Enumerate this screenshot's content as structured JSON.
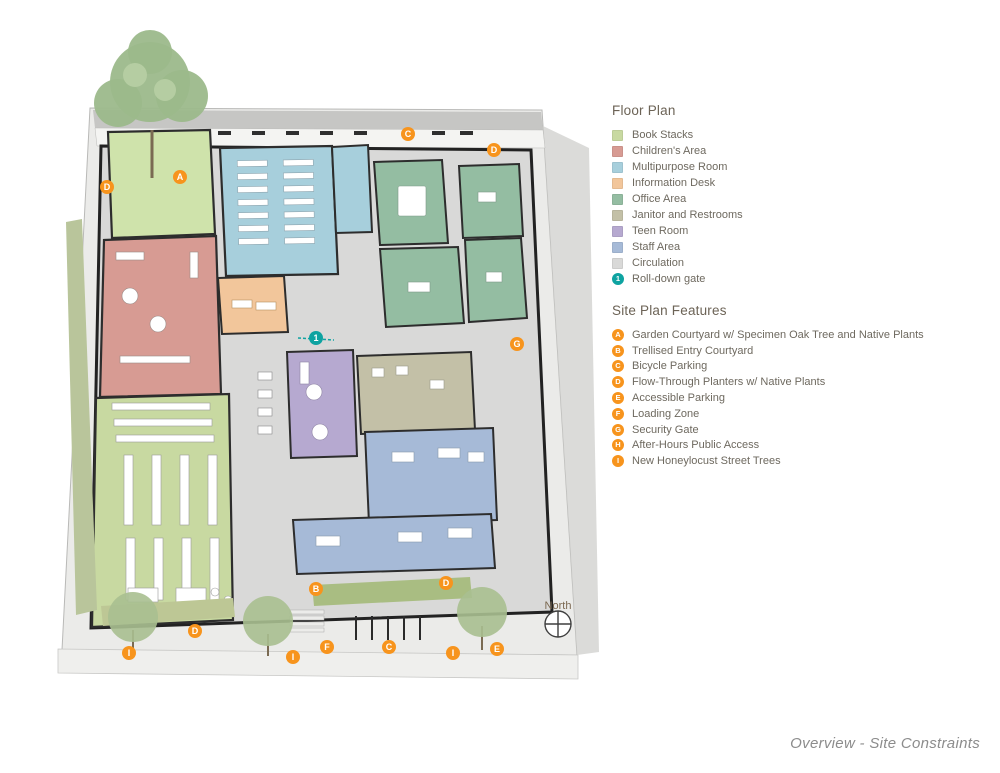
{
  "legend": {
    "floor_plan": {
      "title": "Floor Plan",
      "items": [
        {
          "label": "Book Stacks",
          "color": "#c8d9a1"
        },
        {
          "label": "Children's Area",
          "color": "#d79b93"
        },
        {
          "label": "Multipurpose Room",
          "color": "#a7cfdc"
        },
        {
          "label": "Information Desk",
          "color": "#f2c69b"
        },
        {
          "label": "Office Area",
          "color": "#94bda2"
        },
        {
          "label": "Janitor and Restrooms",
          "color": "#c3c0a7"
        },
        {
          "label": "Teen Room",
          "color": "#b6a9d0"
        },
        {
          "label": "Staff Area",
          "color": "#a6bad7"
        },
        {
          "label": "Circulation",
          "color": "#d9d9d8"
        }
      ],
      "gate": {
        "number": "1",
        "label": "Roll-down gate",
        "color": "#0ea3a1"
      }
    },
    "site_features": {
      "title": "Site Plan Features",
      "marker_color": "#f7941d",
      "items": [
        {
          "letter": "A",
          "label": "Garden Courtyard w/ Specimen Oak Tree and Native Plants"
        },
        {
          "letter": "B",
          "label": "Trellised Entry Courtyard"
        },
        {
          "letter": "C",
          "label": "Bicycle Parking"
        },
        {
          "letter": "D",
          "label": "Flow-Through Planters w/ Native Plants"
        },
        {
          "letter": "E",
          "label": "Accessible Parking"
        },
        {
          "letter": "F",
          "label": "Loading Zone"
        },
        {
          "letter": "G",
          "label": "Security Gate"
        },
        {
          "letter": "H",
          "label": "After-Hours Public Access"
        },
        {
          "letter": "I",
          "label": "New Honeylocust Street Trees"
        }
      ]
    }
  },
  "plan": {
    "north_label": "North",
    "gate_marker": {
      "number": "1"
    },
    "markers": [
      {
        "letter": "A"
      },
      {
        "letter": "B"
      },
      {
        "letter": "C"
      },
      {
        "letter": "C"
      },
      {
        "letter": "D"
      },
      {
        "letter": "D"
      },
      {
        "letter": "D"
      },
      {
        "letter": "D"
      },
      {
        "letter": "E"
      },
      {
        "letter": "F"
      },
      {
        "letter": "G"
      },
      {
        "letter": "I"
      },
      {
        "letter": "I"
      },
      {
        "letter": "I"
      }
    ]
  },
  "footer": {
    "caption": "Overview - Site Constraints"
  }
}
